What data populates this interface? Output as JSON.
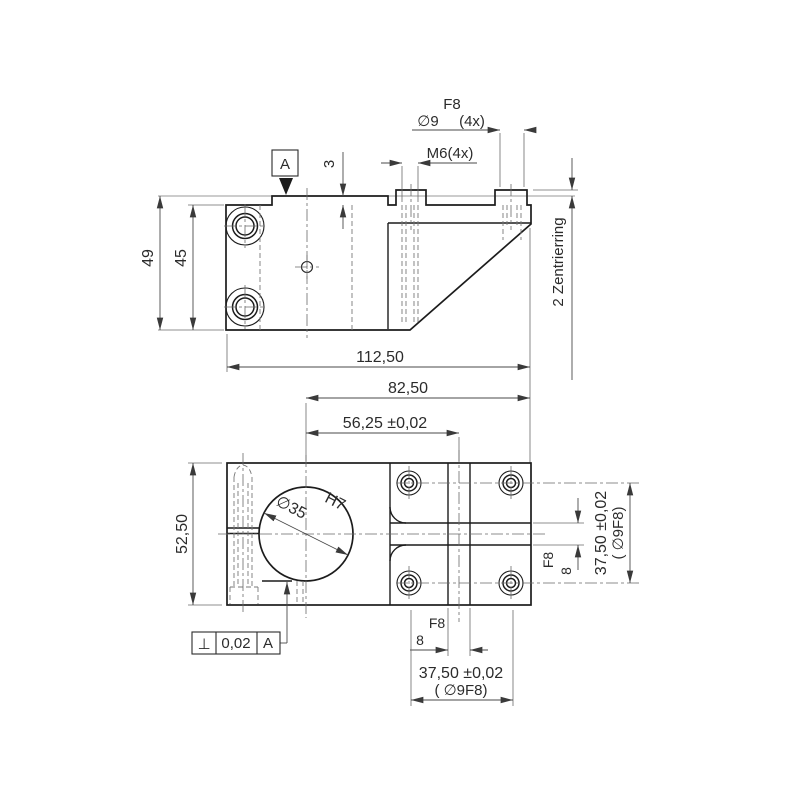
{
  "drawing": {
    "side_view": {
      "datum_label": "A",
      "dim_height_total": "49",
      "dim_height_body": "45",
      "dim_step": "3",
      "label_fit_f8": "F8",
      "label_dia9": "∅9",
      "label_4x": "(4x)",
      "label_m6": "M6(4x)",
      "note_zentrierring": "2 Zentrierring"
    },
    "plan_view": {
      "dim_width_total": "112,50",
      "dim_82_50": "82,50",
      "dim_56_25": "56,25 ±0,02",
      "dim_height": "52,50",
      "bore_dia": "∅35",
      "bore_fit": "H7",
      "right_dims": {
        "slot_fit": "F8",
        "slot_width": "8",
        "hole_spacing": "37,50 ±0,02",
        "hole_spec": "( ∅9F8)"
      },
      "bottom_dims": {
        "slot_fit": "F8",
        "slot_width": "8",
        "hole_spacing": "37,50 ±0,02",
        "hole_spec": "( ∅9F8)"
      },
      "tolerance_frame": {
        "symbol": "⊥",
        "value": "0,02",
        "datum": "A"
      }
    }
  }
}
